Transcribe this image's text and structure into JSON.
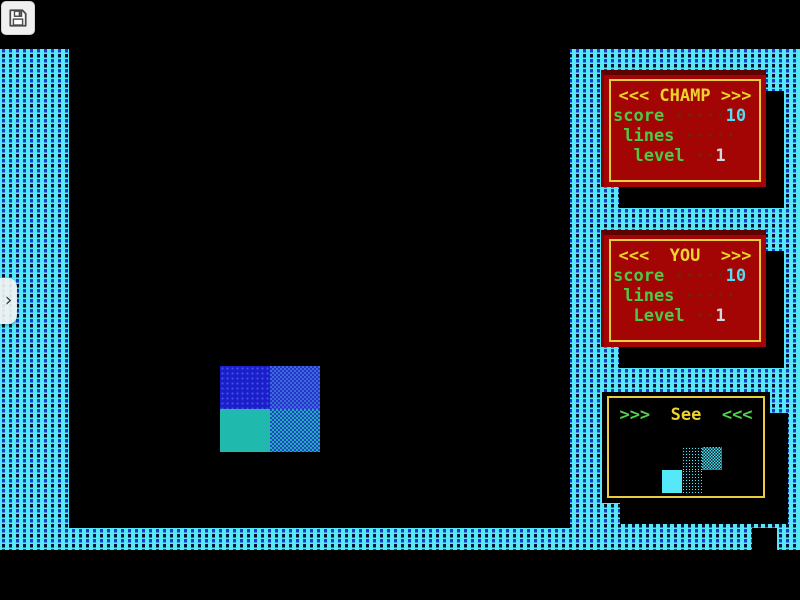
{
  "app": {
    "save_button": {
      "icon": "floppy-save-icon"
    },
    "drawer_tab": {
      "icon": "chevron-right-icon",
      "glyph": "›"
    }
  },
  "colors": {
    "texture_cyan": "#55E8F8",
    "texture_dash_blue": "#1A3ACE",
    "texture_dash_dark": "#041430",
    "panel_red": "#A30404",
    "panel_border_yellow": "#E8CE3E",
    "title_yellow": "#EFD22E",
    "text_green": "#4CCB44",
    "dots_brown": "#6B2A10",
    "value_cyan": "#55DCF0",
    "value_white": "#CDD9E0",
    "block_blue": "#1C1FC9",
    "block_teal": "#1FB9AE"
  },
  "champ_panel": {
    "title": "<<< CHAMP >>>",
    "rows": [
      {
        "label": "score",
        "dots": " ·····",
        "value": "10"
      },
      {
        "label": " lines",
        "dots": " ·····",
        "value": ""
      },
      {
        "label": "  level",
        "dots": " ··",
        "value": "1"
      }
    ]
  },
  "you_panel": {
    "title": "<<<  YOU  >>>",
    "rows": [
      {
        "label": "score",
        "dots": " ·····",
        "value": "10"
      },
      {
        "label": " lines",
        "dots": " ·····",
        "value": ""
      },
      {
        "label": "  Level",
        "dots": " ··",
        "value": "1"
      }
    ]
  },
  "see_panel": {
    "prefix": ">>>  ",
    "title": "See",
    "suffix": "  <<<",
    "next_piece": {
      "shape": "S",
      "cells": [
        "cyan-sparse",
        "cyan-checker",
        "cyan-solid",
        "cyan-sparse"
      ]
    }
  },
  "playfield": {
    "piece": {
      "shape": "O",
      "cells": [
        "blue-dotted",
        "blue-checker",
        "teal-solid",
        "teal-checker"
      ]
    }
  }
}
